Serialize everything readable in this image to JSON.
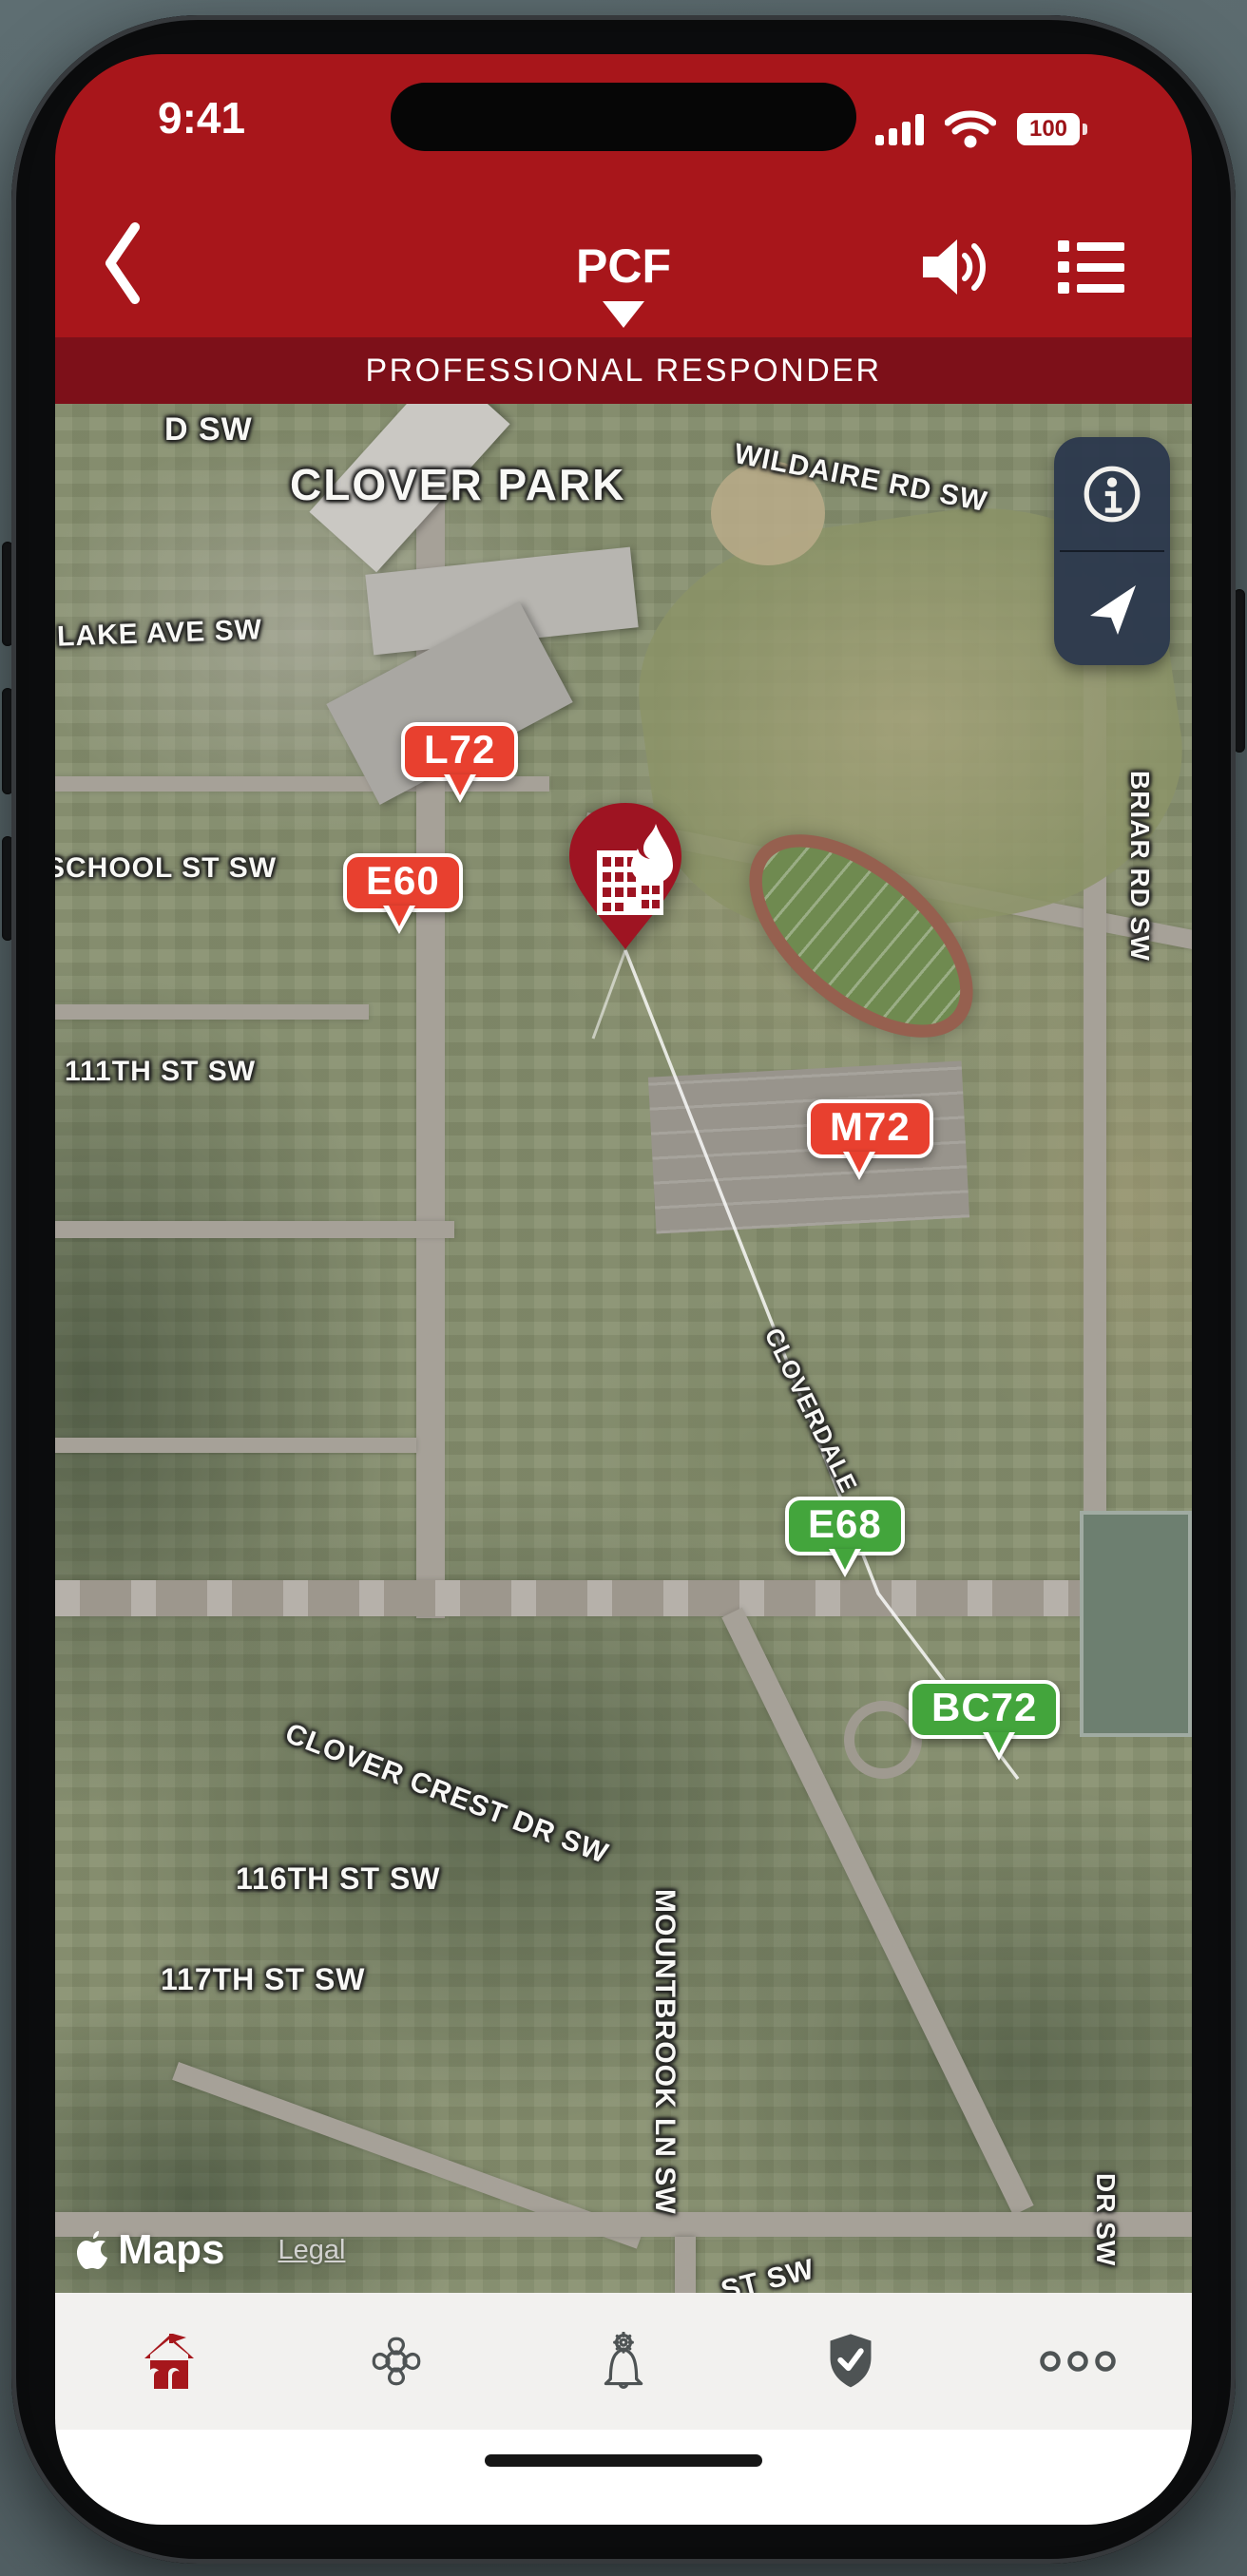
{
  "status_bar": {
    "time": "9:41",
    "battery_percent": "100",
    "signal_icon": "cellular-signal-4-bars",
    "wifi_icon": "wifi",
    "battery_icon": "battery-full"
  },
  "header": {
    "back_icon": "chevron-left",
    "title": "PCF",
    "title_caret_icon": "caret-down",
    "speaker_icon": "speaker-volume",
    "menu_icon": "list-menu",
    "banner": "PROFESSIONAL RESPONDER"
  },
  "map": {
    "area_label": "CLOVER PARK",
    "street_labels": {
      "d_sw": "D SW",
      "wildaire": "WILDAIRE RD SW",
      "lake_ave": "LAKE AVE SW",
      "school_st": "SCHOOL ST SW",
      "st_111": "111TH ST SW",
      "briar_rd": "BRIAR RD SW",
      "cloverdale": "CLOVERDALE",
      "clover_crest": "CLOVER CREST DR SW",
      "st_116": "116TH ST SW",
      "st_117": "117TH ST SW",
      "mountbrook": "MOUNTBROOK LN SW",
      "dr_sw": "DR SW",
      "st_sw": "ST SW"
    },
    "units": [
      {
        "id": "L72",
        "status_color": "#E8402F"
      },
      {
        "id": "E60",
        "status_color": "#E8402F"
      },
      {
        "id": "M72",
        "status_color": "#E8402F"
      },
      {
        "id": "E68",
        "status_color": "#43A53C"
      },
      {
        "id": "BC72",
        "status_color": "#43A53C"
      }
    ],
    "incident": {
      "icon": "building-fire-pin",
      "color": "#9E1422"
    },
    "controls": {
      "info_icon": "info-circle",
      "locate_icon": "navigation-arrow"
    },
    "attribution": {
      "brand_icon": "apple-logo",
      "brand": "Maps",
      "legal": "Legal"
    }
  },
  "tab_bar": {
    "items": [
      {
        "name": "station",
        "icon": "fire-station-icon",
        "active": true
      },
      {
        "name": "department",
        "icon": "maltese-cross-icon",
        "active": false
      },
      {
        "name": "alerts",
        "icon": "bell-gear-icon",
        "active": false
      },
      {
        "name": "shield",
        "icon": "shield-check-icon",
        "active": false
      },
      {
        "name": "more",
        "icon": "ellipsis-icon",
        "active": false
      }
    ]
  },
  "colors": {
    "header_red": "#A8161B",
    "banner_maroon": "#7D1019",
    "unit_red": "#E8402F",
    "unit_green": "#43A53C",
    "incident_pin": "#9E1422",
    "panel_navy": "#2C384D",
    "tab_active": "#A6171C",
    "tab_inactive": "#4E5354"
  }
}
